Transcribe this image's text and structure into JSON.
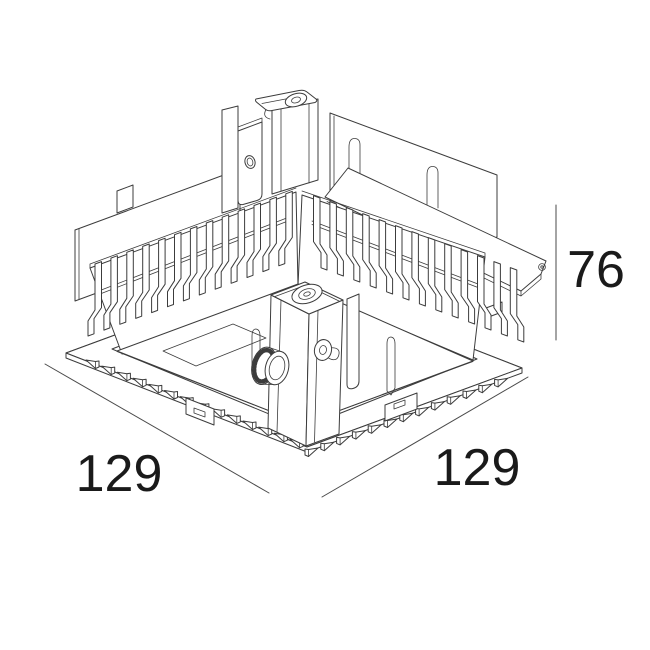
{
  "page": {
    "background": "#ffffff"
  },
  "drawing": {
    "kind": "isometric technical line drawing",
    "subject": "square recessed luminaire housing with heatsink fins, mounting plates, lens module and spring teeth",
    "line_color": "#3c3c3c",
    "label_color": "#1a1a1a"
  },
  "dimensions": {
    "width_left": "129",
    "width_right": "129",
    "height": "76"
  }
}
